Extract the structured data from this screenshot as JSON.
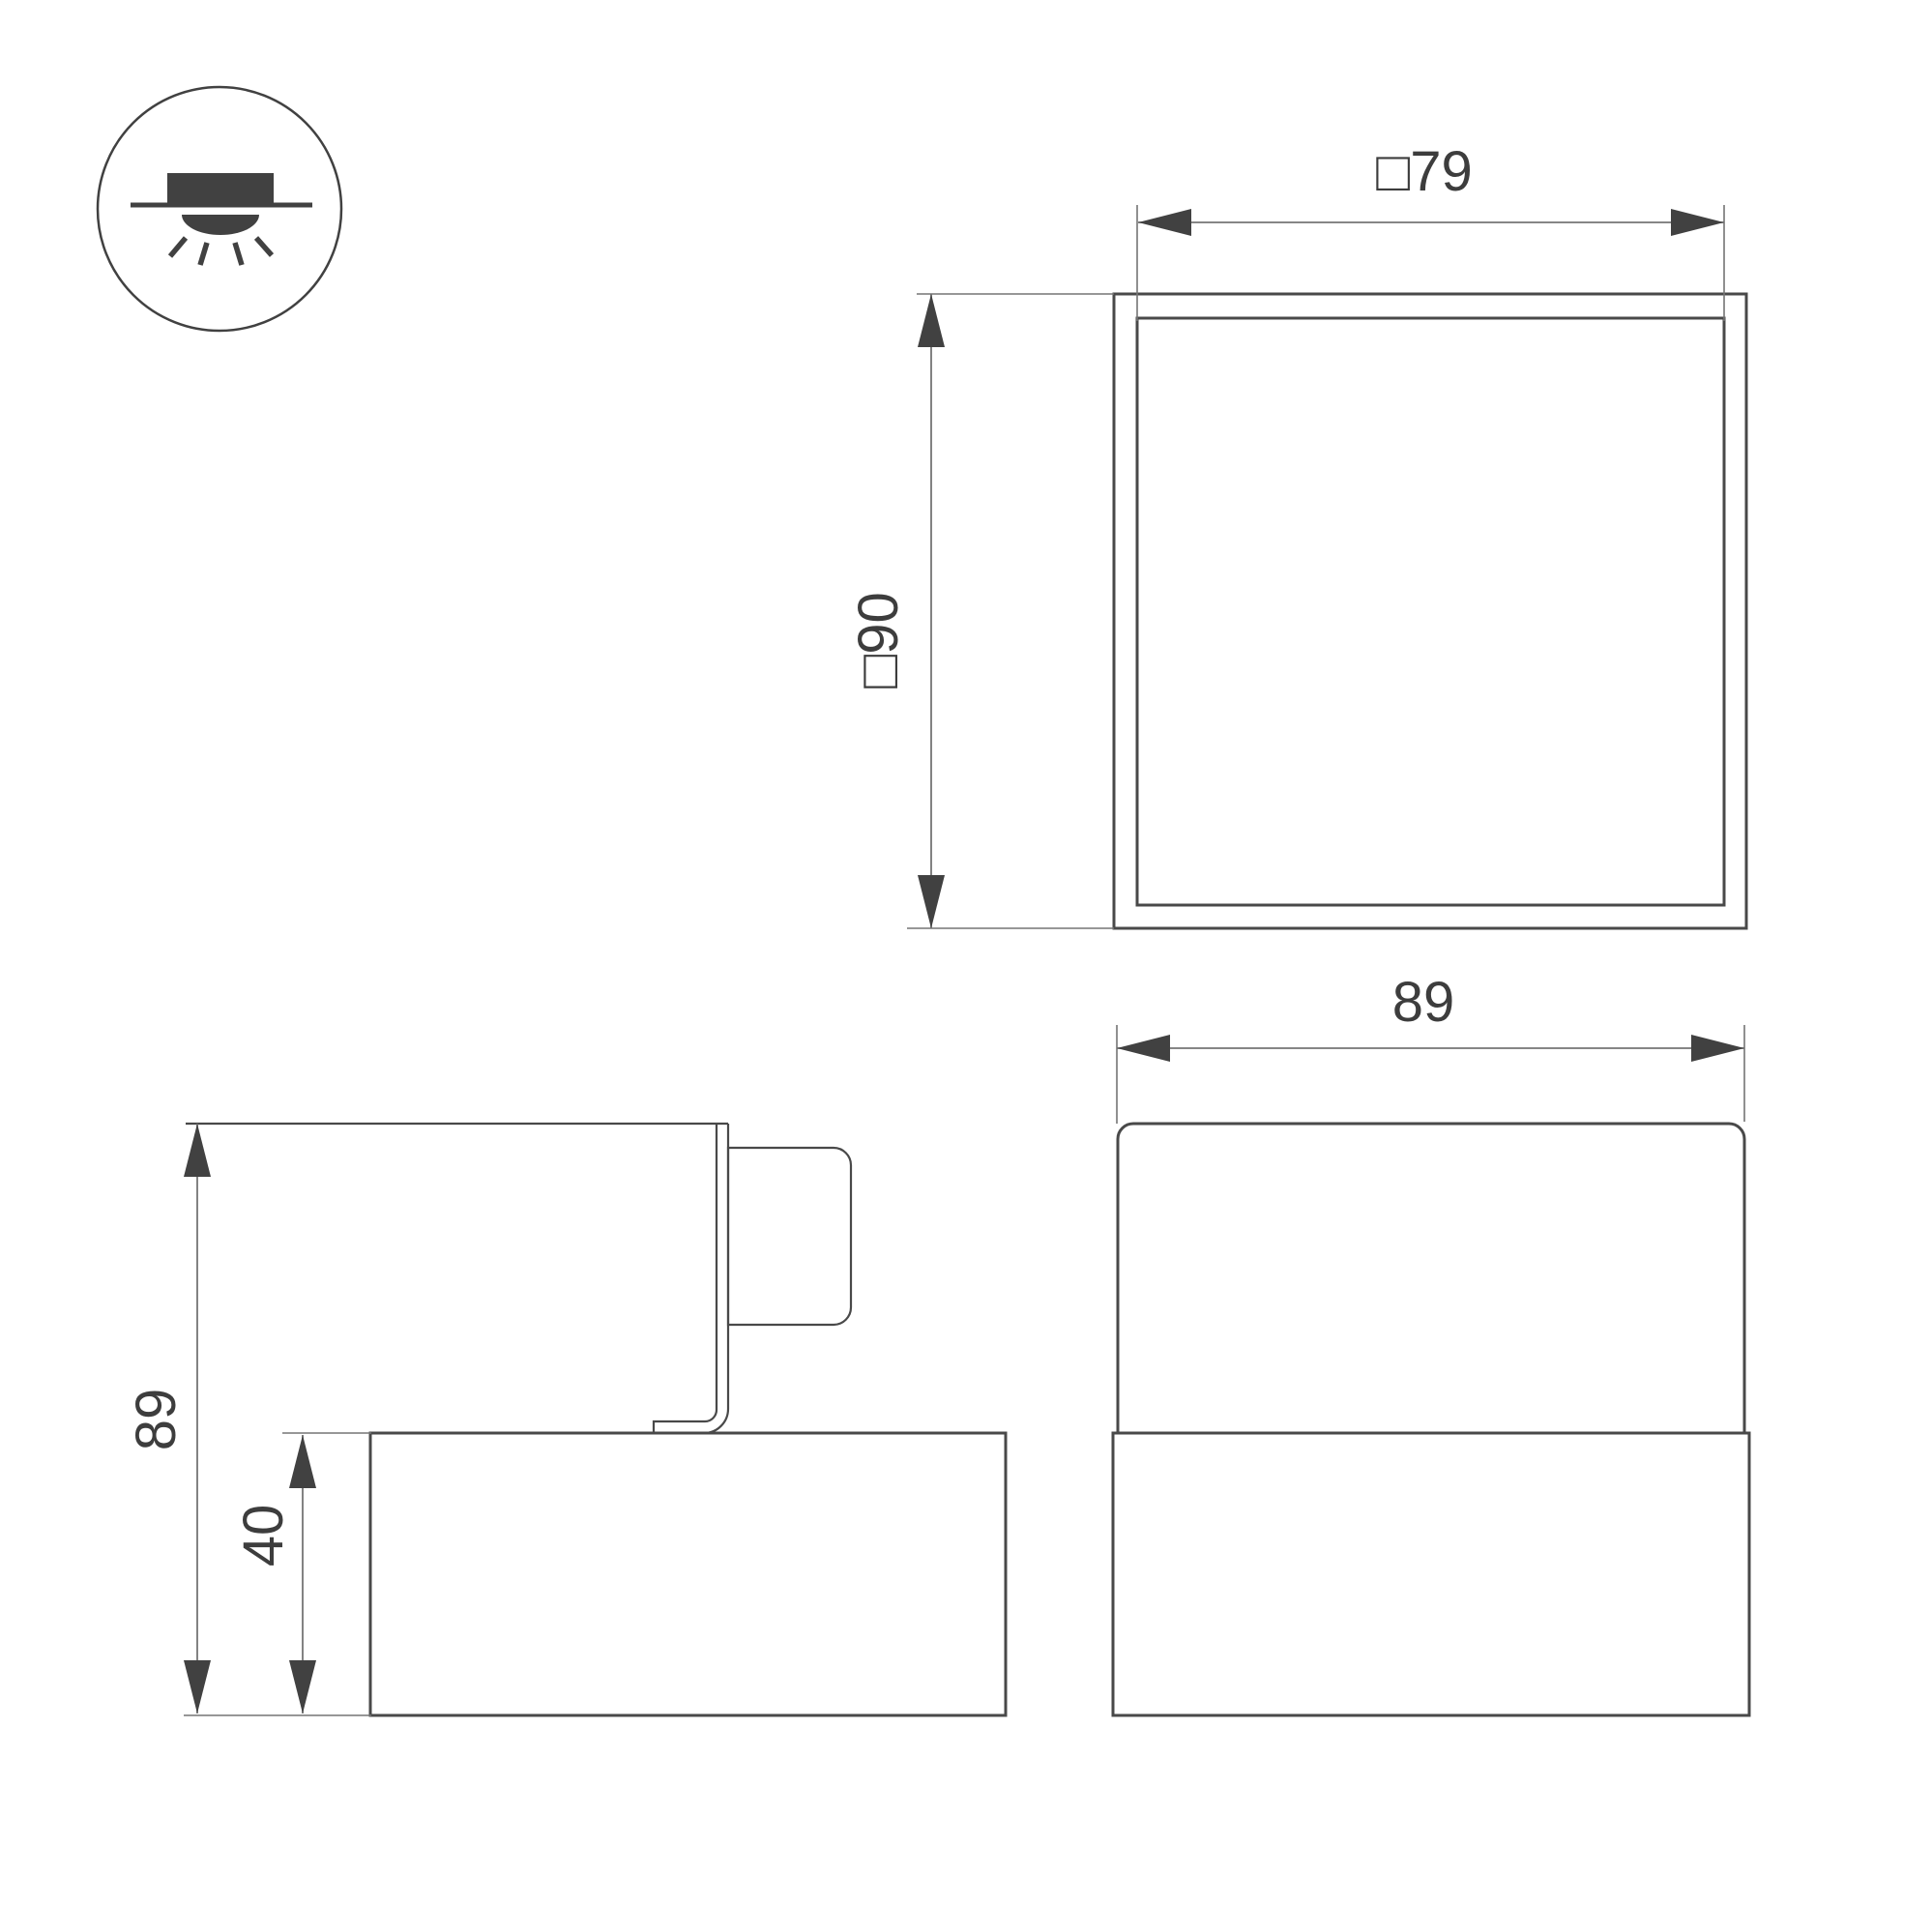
{
  "colors": {
    "line": "#494949",
    "dim": "#757575",
    "arrow": "#414141",
    "text": "#3d3d3d",
    "bg": "#ffffff"
  },
  "icon": {
    "name": "surface-downlight-icon"
  },
  "views": {
    "top_view": {
      "width_label": "□79",
      "height_label": "□90"
    },
    "front_view": {
      "width_label": "89"
    },
    "side_view": {
      "height_label": "89",
      "base_height_label": "40"
    }
  }
}
